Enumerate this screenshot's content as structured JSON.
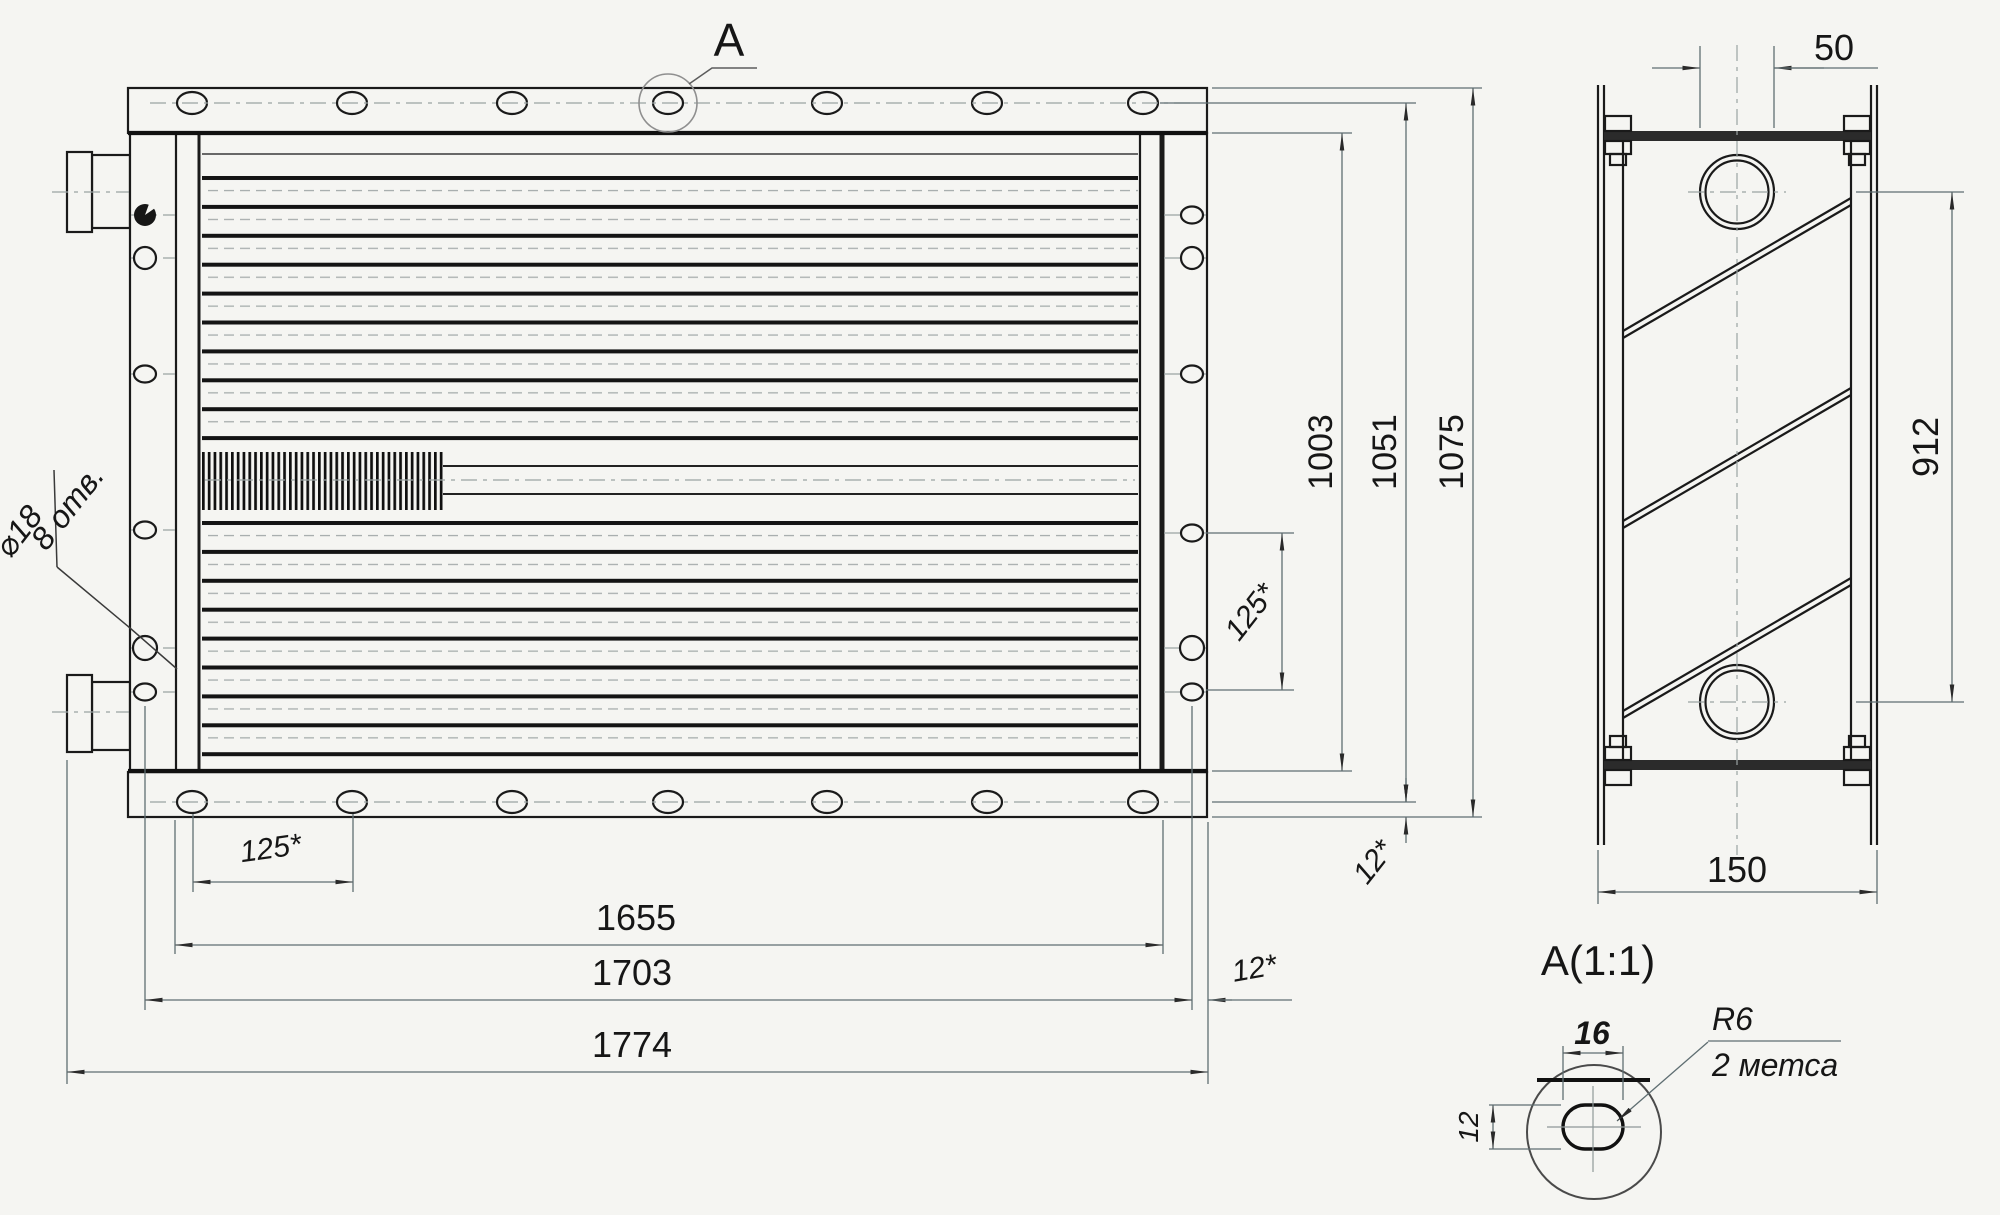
{
  "style": {
    "paper": "#f5f5f2",
    "ink": "#1a1a1a",
    "dim": "#5f6e72"
  },
  "front_view": {
    "section_callout": "A",
    "holes_note": {
      "line1": "⌀18",
      "line2": "8 отв."
    },
    "dims": {
      "bolt_pitch": "125*",
      "body_width": "1655",
      "flange_width": "1703",
      "overall_width": "1774",
      "flange_lip_right": "12*",
      "body_height": "1003",
      "holes_height": "1051",
      "overall_height": "1075",
      "flange_lip_bottom": "12*",
      "side_hole_pitch": "125*"
    }
  },
  "side_view": {
    "dims": {
      "port_width": "50",
      "port_pitch": "912",
      "depth": "150"
    }
  },
  "detail_view": {
    "label": "A(1:1)",
    "dims": {
      "slot_width": "16",
      "slot_height": "12",
      "corner_radius": "R6",
      "places": "2 метса"
    }
  }
}
